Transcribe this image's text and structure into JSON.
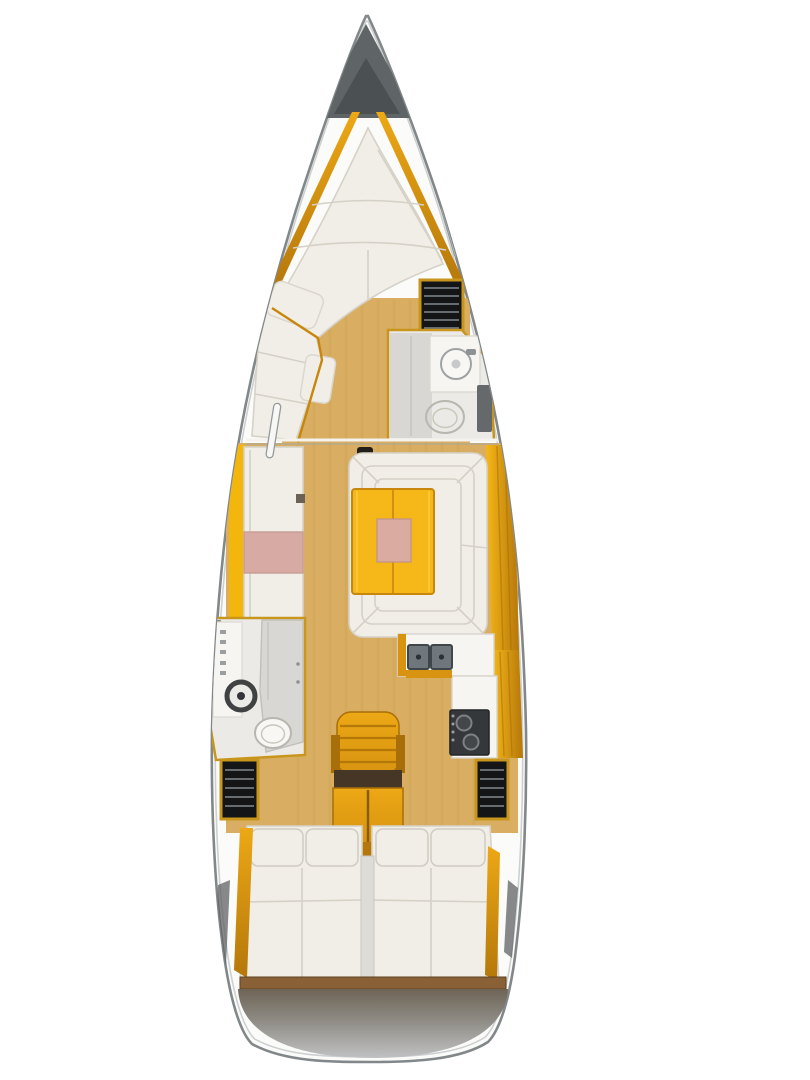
{
  "title": "sailboat-interior-floor-plan-top-view",
  "orientation": "bow-up",
  "components": {
    "bow": [
      "anchor-locker",
      "v-berth",
      "berth-side-rails",
      "deck-window-port",
      "deck-window-starboard"
    ],
    "forward_cabin": [
      "port-chaise-sofa",
      "sofa-pillow",
      "wardrobe-shelves",
      "forward-head",
      "shower-floor",
      "vanity-sink",
      "toilet",
      "head-door"
    ],
    "salon": [
      "port-settee",
      "pink-cushion",
      "u-shaped-dinette",
      "folding-table",
      "table-insert",
      "mast-post",
      "starboard-side-deck"
    ],
    "galley": [
      "counter",
      "double-sink",
      "stove"
    ],
    "midship": [
      "port-aft-head",
      "head-vanity-sink",
      "head-toilet",
      "shower-door",
      "companionway-steps"
    ],
    "aft": [
      "port-hanging-locker",
      "starboard-hanging-locker",
      "port-aft-berth",
      "starboard-aft-berth",
      "berth-pillows",
      "engine-box",
      "transom-platform"
    ]
  },
  "colors": {
    "bg": "#ffffff",
    "hull_fill": "#fbfbfa",
    "hull_outline": "#82888a",
    "hull_inner": "#cdd0d1",
    "locker_outer": "#5f6567",
    "locker_inner": "#4b5052",
    "wood": "#d9ae62",
    "cream": "#f1eee7",
    "pink": "#d7aba3",
    "table_yellow": "#f6b719",
    "table_pink": "#d9aba1",
    "amber": "#d89410",
    "amber_bright": "#f2b60d",
    "amber_light": "#eca815",
    "amber_dark": "#b5770a",
    "white_counter": "#f6f5f2",
    "head_floor": "#eceae6",
    "gray_shower": "#d8d7d3",
    "gray_door": "#66696b",
    "gray_wedge": "#84878a",
    "sink_basin": "#6f777d",
    "appliance_dark": "#35383b",
    "shelf_black": "#141517",
    "toilet_white": "#f8f7f4",
    "mast_black": "#201d1a",
    "step_band": "#463626",
    "divider": "#dedcd7",
    "foot_trim": "#8a6136",
    "transom_top": "#6e6456",
    "transom_bottom": "#c0c1c2",
    "window_fill": "#f7f7f6",
    "floor_mark": "#6b6155"
  }
}
